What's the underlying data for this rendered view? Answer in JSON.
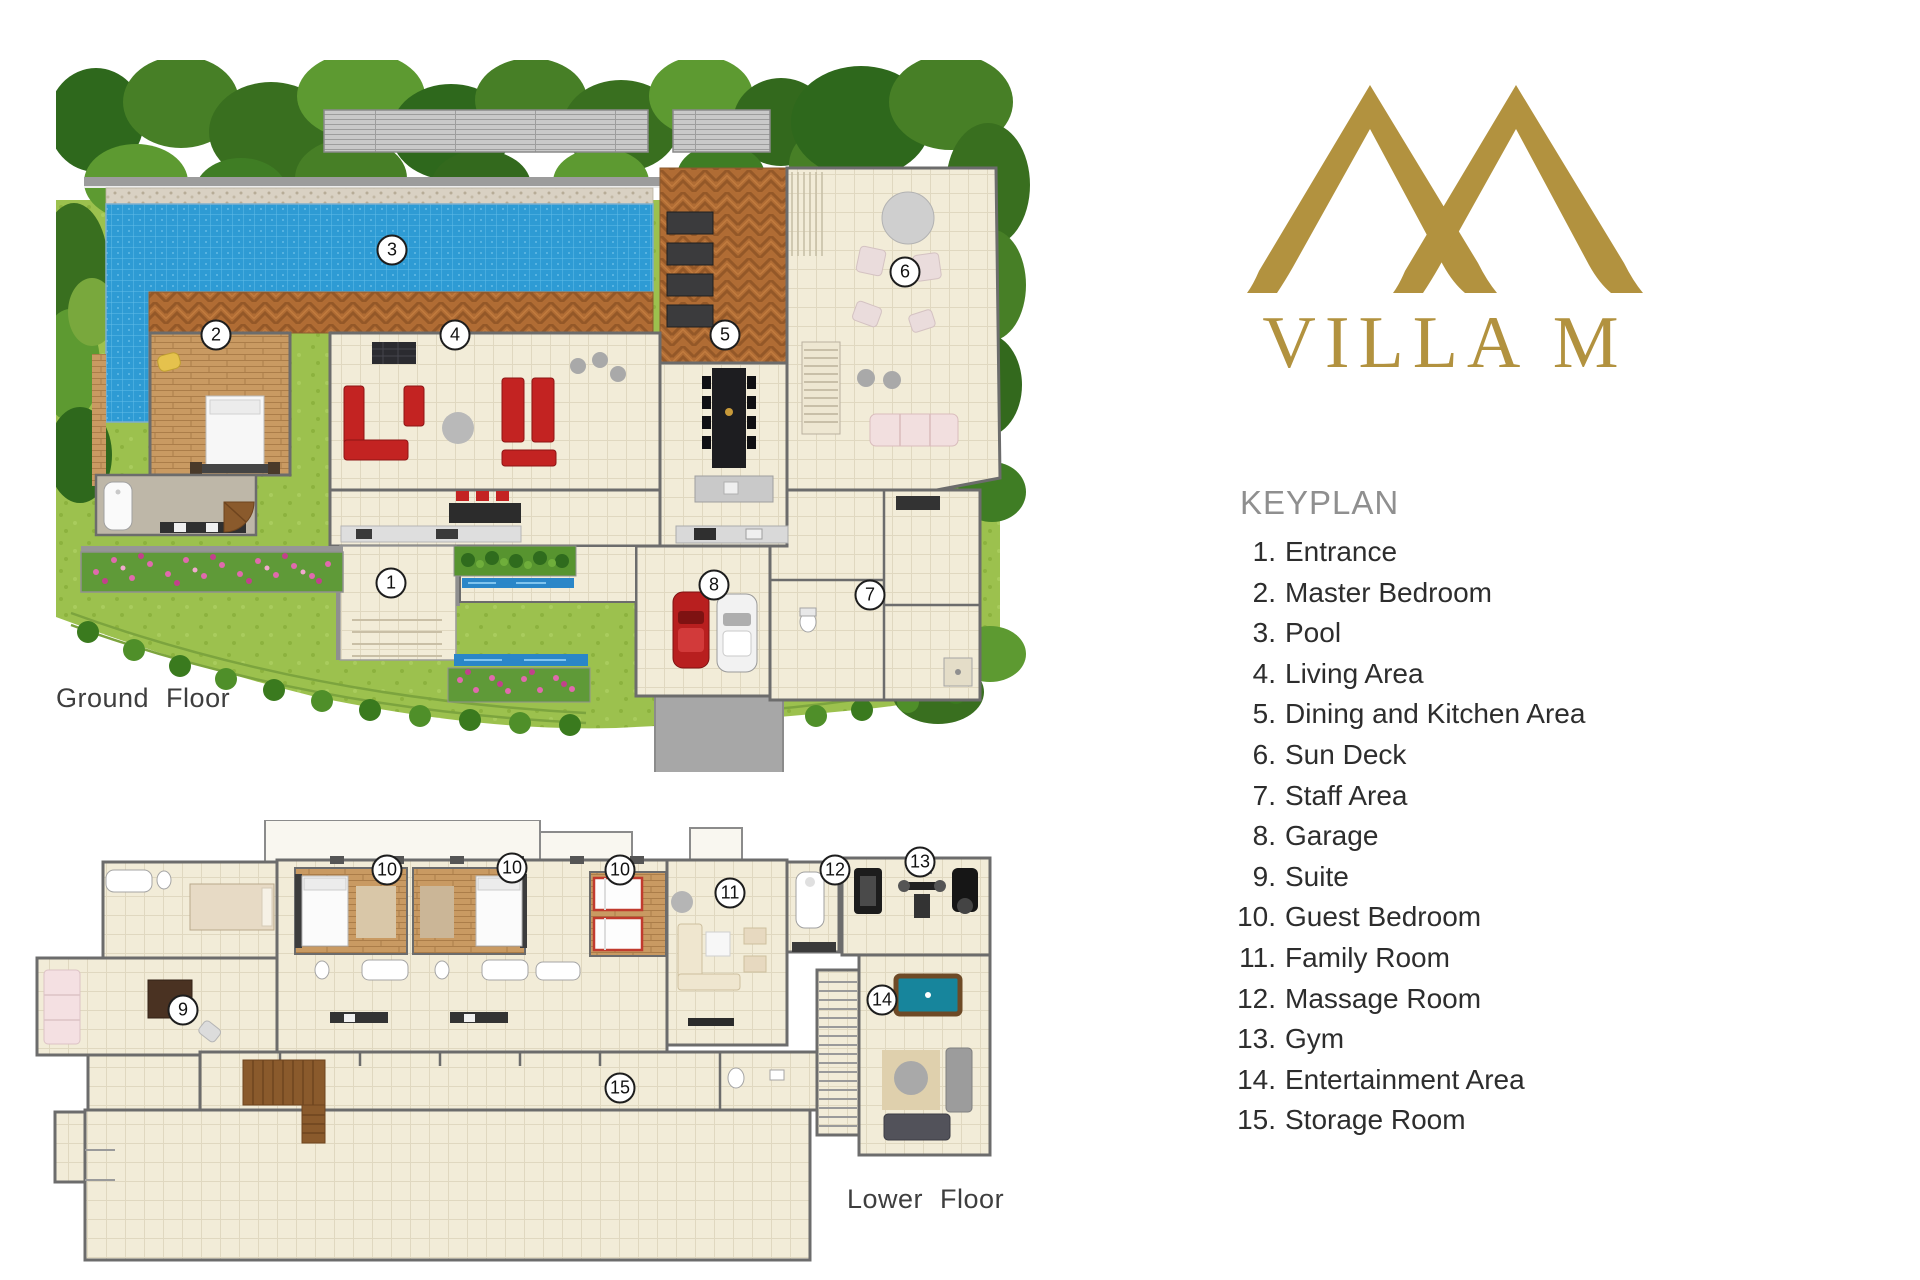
{
  "brand": {
    "monogram": "villa-m-monogram",
    "name": "VILLA M",
    "color": "#b2923f"
  },
  "keyplan": {
    "title": "KEYPLAN",
    "items": [
      {
        "n": "1",
        "label": "Entrance"
      },
      {
        "n": "2",
        "label": "Master Bedroom"
      },
      {
        "n": "3",
        "label": "Pool"
      },
      {
        "n": "4",
        "label": "Living Area"
      },
      {
        "n": "5",
        "label": "Dining and Kitchen Area"
      },
      {
        "n": "6",
        "label": "Sun Deck"
      },
      {
        "n": "7",
        "label": "Staff Area"
      },
      {
        "n": "8",
        "label": "Garage"
      },
      {
        "n": "9",
        "label": "Suite"
      },
      {
        "n": "10",
        "label": "Guest Bedroom"
      },
      {
        "n": "11",
        "label": "Family Room"
      },
      {
        "n": "12",
        "label": "Massage Room"
      },
      {
        "n": "13",
        "label": "Gym"
      },
      {
        "n": "14",
        "label": "Entertainment Area"
      },
      {
        "n": "15",
        "label": "Storage Room"
      }
    ]
  },
  "ground_floor": {
    "label": "Ground Floor",
    "markers": [
      {
        "n": "1",
        "x": 391,
        "y": 583
      },
      {
        "n": "2",
        "x": 216,
        "y": 335
      },
      {
        "n": "3",
        "x": 392,
        "y": 250
      },
      {
        "n": "4",
        "x": 455,
        "y": 335
      },
      {
        "n": "5",
        "x": 725,
        "y": 335
      },
      {
        "n": "6",
        "x": 905,
        "y": 272
      },
      {
        "n": "7",
        "x": 870,
        "y": 595
      },
      {
        "n": "8",
        "x": 714,
        "y": 585
      }
    ]
  },
  "lower_floor": {
    "label": "Lower Floor",
    "markers": [
      {
        "n": "9",
        "x": 183,
        "y": 1010
      },
      {
        "n": "10",
        "x": 387,
        "y": 870
      },
      {
        "n": "10",
        "x": 512,
        "y": 868
      },
      {
        "n": "10",
        "x": 620,
        "y": 870
      },
      {
        "n": "11",
        "x": 730,
        "y": 893
      },
      {
        "n": "12",
        "x": 835,
        "y": 870
      },
      {
        "n": "13",
        "x": 920,
        "y": 862
      },
      {
        "n": "14",
        "x": 882,
        "y": 1000
      },
      {
        "n": "15",
        "x": 620,
        "y": 1088
      }
    ]
  },
  "colors": {
    "brand_gold": "#b2923f",
    "pool_blue": "#2e9bd4",
    "deck_wood": "#b06c34",
    "bedroom_wood": "#c99a62",
    "floor_cream": "#f2ecd8",
    "lawn_green": "#9cc14e",
    "foliage_green": "#477f26",
    "wall_grey": "#6c6c6c",
    "marker_border": "#1d1d1d",
    "sofa_red": "#c32322",
    "billiard_teal": "#17859c",
    "heading_grey": "#8f8f8f",
    "text_dark": "#2d2d2d"
  }
}
